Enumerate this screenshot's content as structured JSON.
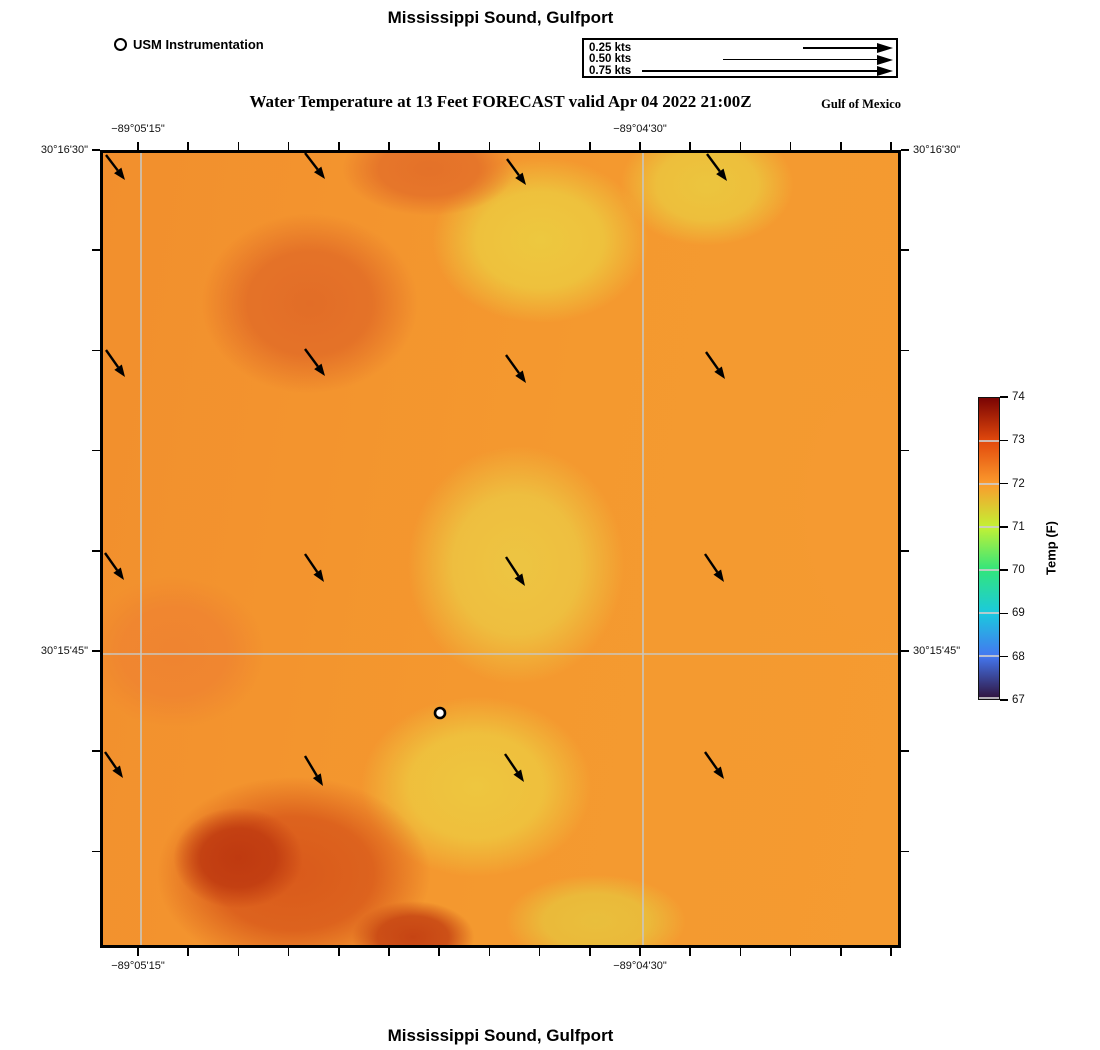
{
  "header": {
    "title": "Mississippi Sound, Gulfport",
    "station_legend": "USM Instrumentation",
    "subtitle": "Water Temperature at 13 Feet FORECAST valid Apr 04 2022 21:00Z",
    "region": "Gulf of Mexico"
  },
  "footer": {
    "title": "Mississippi Sound, Gulfport"
  },
  "chart_data": {
    "type": "heatmap",
    "overlays": [
      "current_vector_field",
      "station_marker",
      "lat_lon_grid"
    ],
    "title": "Mississippi Sound, Gulfport",
    "plot_heading": "Water Temperature at 13 Feet FORECAST valid Apr 04 2022 21:00Z",
    "region_label": "Gulf of Mexico",
    "current_scale": {
      "items": [
        {
          "label": "0.25 kts",
          "shaft_start_px": 219
        },
        {
          "label": "0.50 kts",
          "shaft_start_px": 139
        },
        {
          "label": "0.75 kts",
          "shaft_start_px": 58
        }
      ],
      "tip_px": 309
    },
    "x_axis": {
      "ticks": [
        {
          "label": "−89°05'15\"",
          "x_px": 38
        },
        {
          "label": "−89°04'30\"",
          "x_px": 540
        }
      ],
      "minor_tick_start_px": 38,
      "minor_tick_step_px": 50.2,
      "minor_tick_count": 16
    },
    "y_axis": {
      "ticks": [
        {
          "label": "30°16'30\"",
          "y_px": 0
        },
        {
          "label": "30°15'45\"",
          "y_px": 501
        }
      ],
      "minor_tick_start_px": 0,
      "minor_tick_step_px": 100.2,
      "minor_tick_count": 8
    },
    "gridlines": {
      "v_px": [
        38,
        540
      ],
      "h_px": [
        501
      ],
      "color": "#c9c6be"
    },
    "colorbar": {
      "label": "Temp (F)",
      "min": 67,
      "max": 74,
      "tick_values": [
        74,
        73,
        72,
        71,
        70,
        69,
        68,
        67
      ],
      "colormap": "turbo",
      "stops": [
        [
          "74",
          "#7a0403"
        ],
        [
          "73",
          "#e2490c"
        ],
        [
          "72",
          "#fb9b2d"
        ],
        [
          "71",
          "#c3f134"
        ],
        [
          "70",
          "#32e57c"
        ],
        [
          "69",
          "#1bc9de"
        ],
        [
          "68",
          "#4477f0"
        ],
        [
          "67",
          "#30123b"
        ]
      ]
    },
    "station_marker": {
      "x_px": 337,
      "y_px": 560
    },
    "current_vectors": [
      {
        "x": 3,
        "y": 2,
        "dx": 19,
        "dy": 25
      },
      {
        "x": 202,
        "y": 0,
        "dx": 20,
        "dy": 26
      },
      {
        "x": 404,
        "y": 6,
        "dx": 19,
        "dy": 26
      },
      {
        "x": 604,
        "y": 1,
        "dx": 20,
        "dy": 27
      },
      {
        "x": 3,
        "y": 197,
        "dx": 19,
        "dy": 27
      },
      {
        "x": 202,
        "y": 196,
        "dx": 20,
        "dy": 27
      },
      {
        "x": 403,
        "y": 202,
        "dx": 20,
        "dy": 28
      },
      {
        "x": 603,
        "y": 199,
        "dx": 19,
        "dy": 27
      },
      {
        "x": 2,
        "y": 400,
        "dx": 19,
        "dy": 27
      },
      {
        "x": 202,
        "y": 401,
        "dx": 19,
        "dy": 28
      },
      {
        "x": 403,
        "y": 404,
        "dx": 19,
        "dy": 29
      },
      {
        "x": 602,
        "y": 401,
        "dx": 19,
        "dy": 28
      },
      {
        "x": 2,
        "y": 599,
        "dx": 18,
        "dy": 26
      },
      {
        "x": 202,
        "y": 603,
        "dx": 18,
        "dy": 30
      },
      {
        "x": 402,
        "y": 601,
        "dx": 19,
        "dy": 28
      },
      {
        "x": 602,
        "y": 599,
        "dx": 19,
        "dy": 27
      }
    ],
    "vector_note": "all arrows point SSE, length well below the 0.25 kts scale arrow",
    "field_estimates_f": [
      {
        "region": "northwest lobe",
        "value": 72.7
      },
      {
        "region": "north-center / upper-middle band",
        "value": 71.6
      },
      {
        "region": "center near station",
        "value": 71.5
      },
      {
        "region": "east side",
        "value": 72.2
      },
      {
        "region": "southwest maximum (dark red)",
        "value": 73.6
      },
      {
        "region": "south-center yellow minimum",
        "value": 71.4
      }
    ],
    "base_gradient": [
      "#f28f2d",
      "#f4992f",
      "#f59b31"
    ],
    "heat_blobs": [
      {
        "cx": 17,
        "cy": 89,
        "rx": 90,
        "ry": 70,
        "color": "#bf3a10"
      },
      {
        "cx": 39,
        "cy": 99,
        "rx": 85,
        "ry": 50,
        "color": "#c64413"
      },
      {
        "cx": 24,
        "cy": 91,
        "rx": 190,
        "ry": 135,
        "color": "#d95a1b"
      },
      {
        "cx": 26,
        "cy": 19,
        "rx": 150,
        "ry": 125,
        "color": "#e26d27"
      },
      {
        "cx": 41,
        "cy": 2,
        "rx": 120,
        "ry": 65,
        "color": "#e47129"
      },
      {
        "cx": 55,
        "cy": 11,
        "rx": 150,
        "ry": 115,
        "color": "#edc83f"
      },
      {
        "cx": 76,
        "cy": 4,
        "rx": 120,
        "ry": 85,
        "color": "#ecc53e"
      },
      {
        "cx": 52,
        "cy": 52,
        "rx": 150,
        "ry": 165,
        "color": "#edc542"
      },
      {
        "cx": 47,
        "cy": 80,
        "rx": 160,
        "ry": 125,
        "color": "#eec63f"
      },
      {
        "cx": 62,
        "cy": 97,
        "rx": 125,
        "ry": 65,
        "color": "#e9bf3c"
      },
      {
        "cx": 9,
        "cy": 63,
        "rx": 125,
        "ry": 105,
        "color": "#ef8430"
      },
      {
        "cx": 96,
        "cy": 45,
        "rx": 130,
        "ry": 240,
        "color": "#f59a31"
      }
    ]
  }
}
